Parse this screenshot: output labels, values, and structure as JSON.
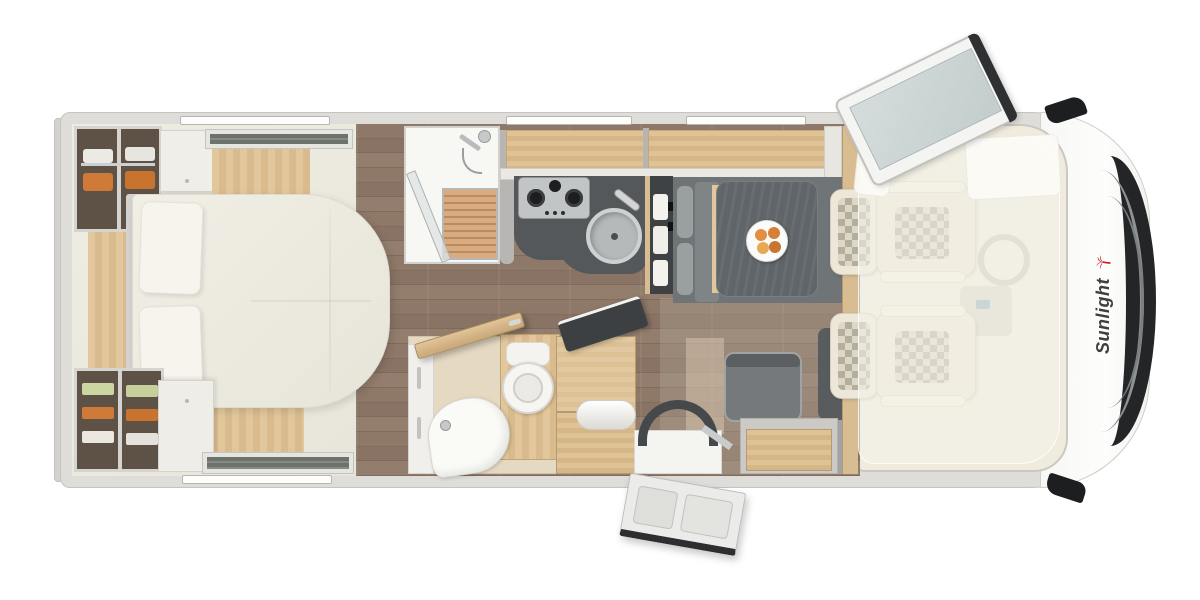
{
  "brand": {
    "name": "Sunlight",
    "text_color": "#3e3f3f",
    "palm_color": "#c8202a"
  },
  "colors": {
    "page_background": "#ffffff",
    "body_wall": "#deddda",
    "hood": "#fcfcfa",
    "grille": "#232527",
    "cab_interior": "#efecdd",
    "bedroom_floor": "#eceade",
    "plank_floor": "#87715f",
    "light_wood": "#dcc094",
    "counter_dark": "#54585b",
    "table_gray": "#5f6569",
    "seat_gray": "#76797b",
    "upholstery_cream": "#ece7d8",
    "duvet": "#efede3",
    "clothes_orange": "#cf7a38",
    "clothes_green": "#ccd6a2"
  },
  "fixtures": [
    "island-bed",
    "pillows",
    "wardrobe-hanging",
    "wardrobe-shelves",
    "roof-skylight-rear",
    "roof-skylight-front",
    "awning-rails",
    "shower-cabin",
    "shower-head",
    "shower-glass",
    "bathroom-door",
    "toilet",
    "washbasin",
    "storage-chest",
    "towel-roll",
    "gas-hob",
    "kitchen-sink",
    "faucet",
    "refrigerator",
    "overhead-lockers",
    "dinette-table",
    "fruit-plate",
    "bench-seat",
    "side-seat",
    "sideboard",
    "entry-step",
    "entry-door",
    "cab-seat-top",
    "cab-seat-bottom",
    "drop-down-bed",
    "steering-wheel",
    "dashboard",
    "wing-mirror-top",
    "wing-mirror-bottom",
    "cab-roof-window",
    "front-grille",
    "rear-bumper"
  ]
}
